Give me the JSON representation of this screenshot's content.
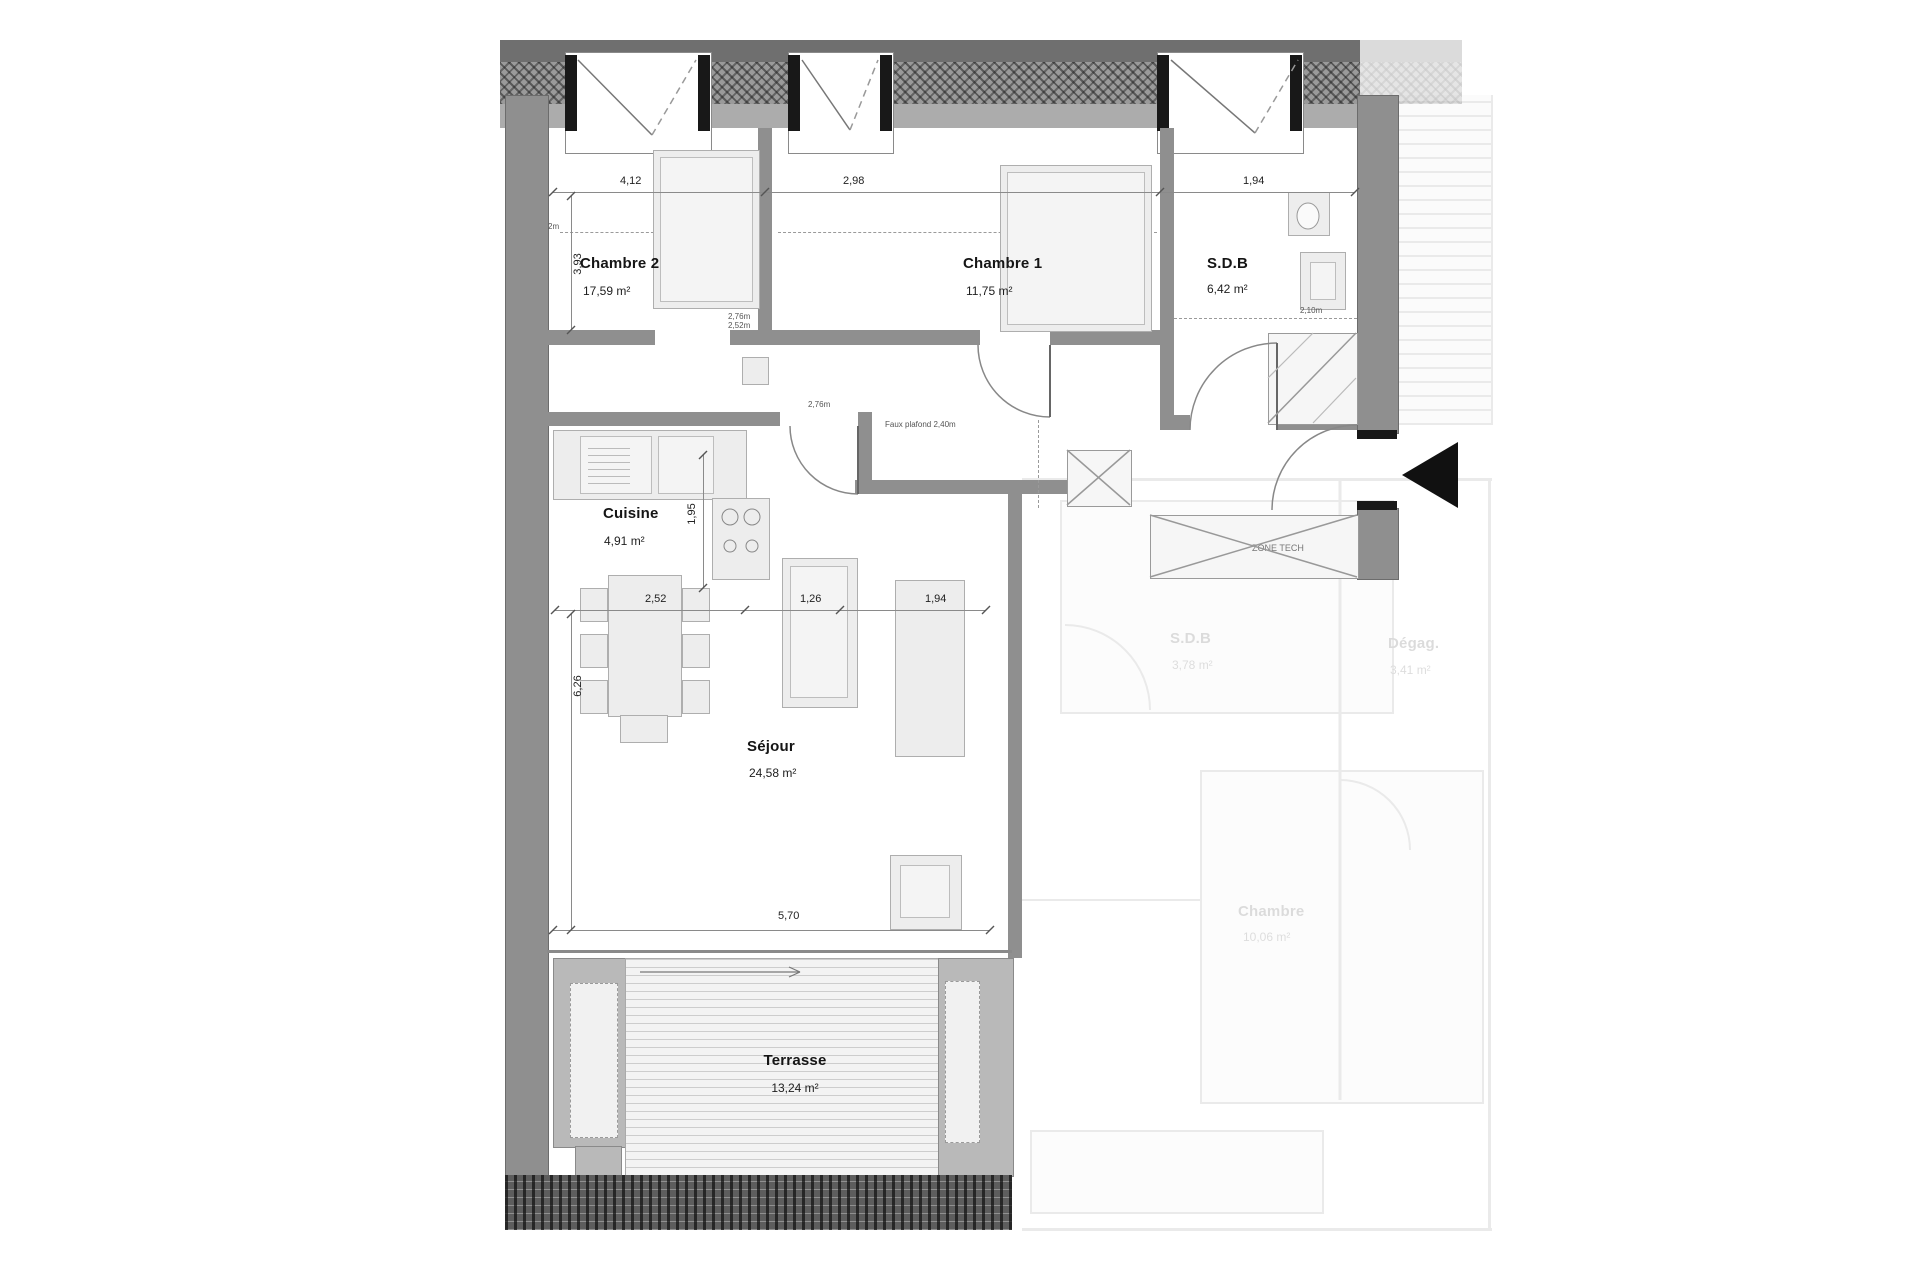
{
  "drawing": {
    "type": "apartment-floor-plan",
    "language": "fr"
  },
  "rooms": [
    {
      "id": "chambre2",
      "name": "Chambre 2",
      "area": "17,59 m²"
    },
    {
      "id": "chambre1",
      "name": "Chambre 1",
      "area": "11,75 m²"
    },
    {
      "id": "sdb",
      "name": "S.D.B",
      "area": "6,42 m²"
    },
    {
      "id": "cuisine",
      "name": "Cuisine",
      "area": "4,91 m²"
    },
    {
      "id": "sejour",
      "name": "Séjour",
      "area": "24,58 m²"
    },
    {
      "id": "terrasse",
      "name": "Terrasse",
      "area": "13,24 m²"
    }
  ],
  "dimensions": {
    "top": [
      "4,12",
      "2,98",
      "1,94"
    ],
    "middle": [
      "2,52",
      "1,26",
      "1,94"
    ],
    "bottom": "5,70",
    "left_upper": "3,93",
    "left_lower": "6,26",
    "kitchen_depth": "1,95",
    "sdb_inner": "2,10m"
  },
  "annotations": {
    "zone_tech": "ZONE TECH",
    "faux_plafond": "Faux plafond 2,40m",
    "ceiling_small_a": "2,76m",
    "ceiling_small_b": "2,52m",
    "ceiling_left": "2m"
  },
  "adjacent_unit": {
    "rooms": [
      {
        "name": "S.D.B",
        "area": "3,78 m²"
      },
      {
        "name": "Dégag.",
        "area": "3,41 m²"
      },
      {
        "name": "Chambre",
        "area": "10,06 m²"
      }
    ]
  },
  "colors": {
    "wall": "#8f8f8f",
    "wall_dark": "#6f6f6f",
    "wall_light": "#acacac",
    "line": "#888888",
    "text": "#151515",
    "furniture": "#ededed",
    "entrance_marker": "#111111"
  }
}
